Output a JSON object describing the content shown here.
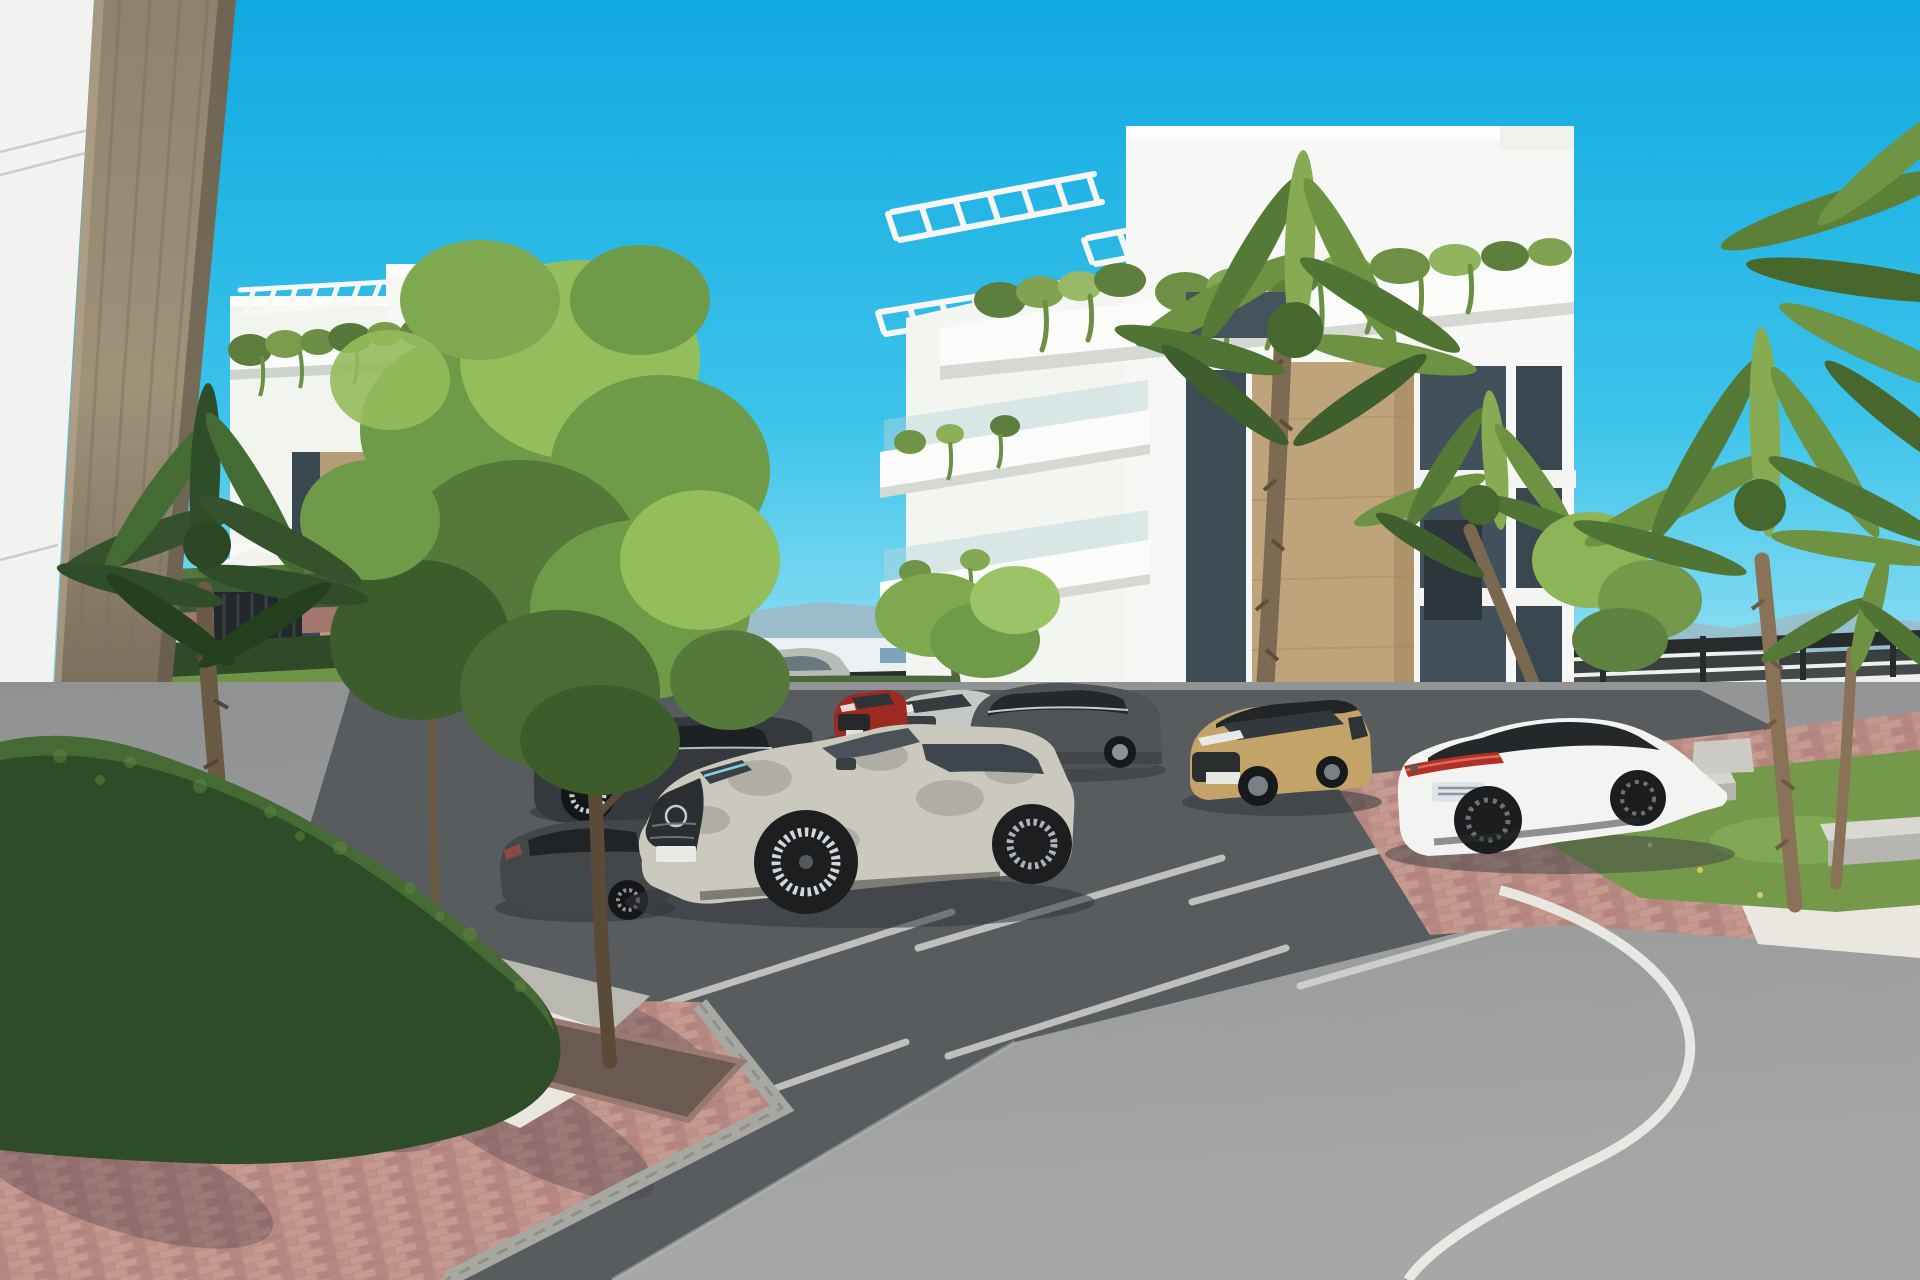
{
  "scene": {
    "description": "Sunny 3D architectural rendering of a modern white apartment complex with landscaped parking, palm trees and parked cars",
    "sky": {
      "top": "#0fa9e0",
      "mid": "#3cc3ea",
      "horizon": "#aee9f6"
    },
    "background": {
      "mountains": "#9db8c6",
      "town_strip": "#eaf0f3",
      "town_window": "#7fa3ba",
      "perimeter_wall": "#eef0ee",
      "fence_dark": "#2a2d2e"
    },
    "buildings": {
      "left": {
        "label": "left apartment block",
        "wall": "#f7f8f5",
        "wall_shade": "#f2f4f0",
        "slab": "#fbfcfa",
        "slab_shadow": "#d4d7d1",
        "stone": "#b59c76",
        "window": "#3a484f"
      },
      "right": {
        "label": "right apartment block",
        "wall": "#f7f8f5",
        "wing": "#f3f5f1",
        "slab": "#fbfcfa",
        "slab_shadow": "#d6d9d3",
        "stone": "#bfa37b",
        "window": "#3d4c55",
        "railing_glass": "#b8d4da"
      }
    },
    "foreground_wall": {
      "white": "#f2f3f1",
      "column_top": "#8f816c",
      "column_mid": "#a09279",
      "column_low": "#776b5a",
      "column_base": "#595246"
    },
    "vegetation": {
      "tree_light": "#94bd5c",
      "tree_mid": "#6f9a47",
      "tree_dark": "#3c5c2c",
      "palm_light": "#87ab52",
      "palm_mid": "#6d9242",
      "palm_dark": "#4f7434",
      "left_palm_dark": "#35522c",
      "hedge_dark": "#2e4c27",
      "hedge_light": "#4a7036",
      "grass": "#74994a",
      "lawn": "#6f9447",
      "trunk": "#6b5b45",
      "palm_trunk": "#8a7258"
    },
    "ground": {
      "asphalt_road": "#9b9d9e",
      "asphalt_parking": "#585c5f",
      "brick": "#b98c84",
      "gravel": "#e9e7df",
      "curb": "#a8a8a2",
      "road_line": "#ebebe7",
      "stall_line": "#d9dad6",
      "shadow": "#4a3a48"
    },
    "site_furniture": {
      "umbrella": "#f2f2ee",
      "lounger": "#eceee9",
      "bench": "#d9d8d2",
      "bench_side": "#b6b5af",
      "gate_dark": "#23282b",
      "planter": "#cbcac4"
    },
    "vehicles": [
      {
        "id": "distant-silver-car",
        "kind": "sedan driving behind hedge",
        "body": "#b9bcb6"
      },
      {
        "id": "dark-sedan",
        "kind": "parked dark sedan",
        "body": "#35383c"
      },
      {
        "id": "foreground-dark-car",
        "kind": "parked car lower left",
        "body": "#43474a"
      },
      {
        "id": "red-suv",
        "kind": "parked red compact SUV",
        "body": "#9c2a22"
      },
      {
        "id": "silver-compact-suv",
        "kind": "parked silver compact SUV",
        "body": "#c6c8c5"
      },
      {
        "id": "dark-gray-suv",
        "kind": "parked dark gray SUV",
        "body": "#4f5355"
      },
      {
        "id": "silver-suv",
        "kind": "foreground silver SUV coupe",
        "body": "#cbc8be"
      },
      {
        "id": "tan-suv",
        "kind": "parked tan SUV with black roof",
        "body": "#c4a369"
      },
      {
        "id": "white-sedan",
        "kind": "parked white fastback sedan",
        "body": "#f3f3f1",
        "tail_light": "#b03028"
      }
    ]
  }
}
